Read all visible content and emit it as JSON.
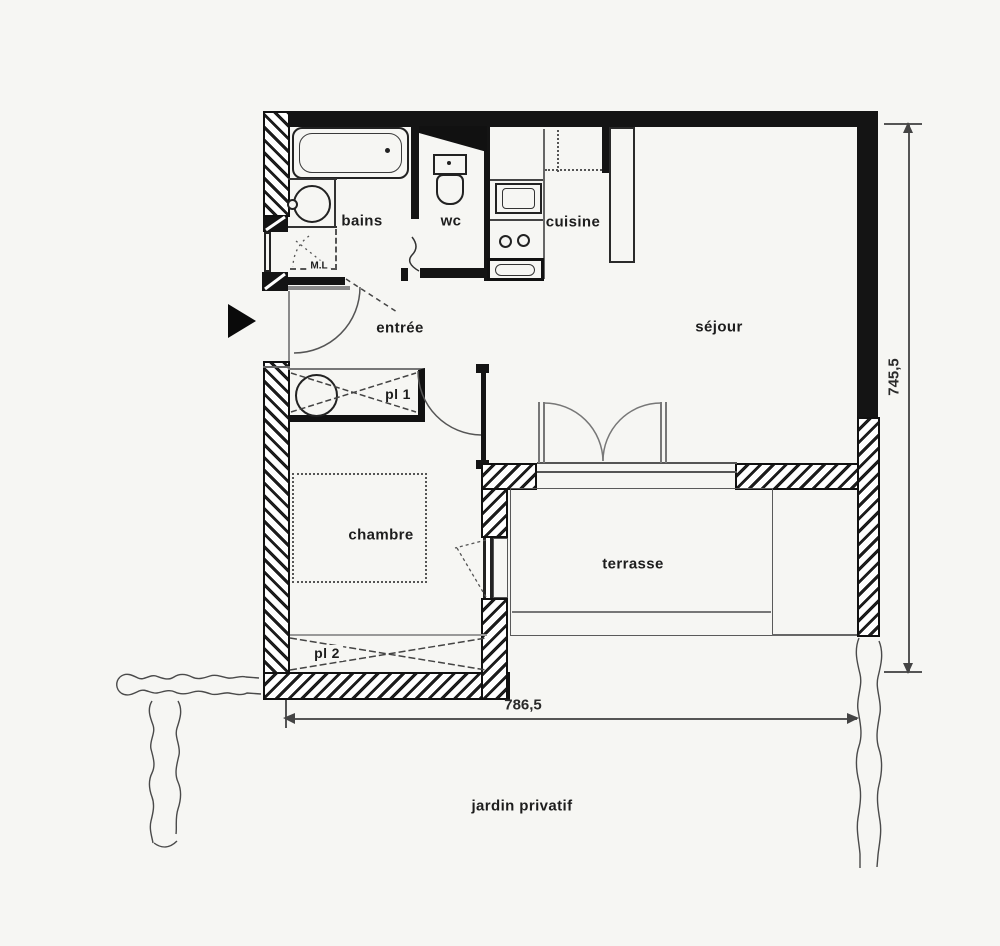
{
  "floorplan": {
    "rooms": {
      "bains": "bains",
      "wc": "wc",
      "cuisine": "cuisine",
      "entree": "entrée",
      "sejour": "séjour",
      "chambre": "chambre",
      "terrasse": "terrasse"
    },
    "closets": {
      "pl1": "pl 1",
      "pl2": "pl 2"
    },
    "labels": {
      "washer": "M.L",
      "garden": "jardin privatif"
    },
    "dimensions": {
      "width_cm": "786,5",
      "height_cm": "745,5"
    },
    "colors": {
      "background": "#f6f6f3",
      "wall": "#141414",
      "line": "#555555"
    }
  }
}
